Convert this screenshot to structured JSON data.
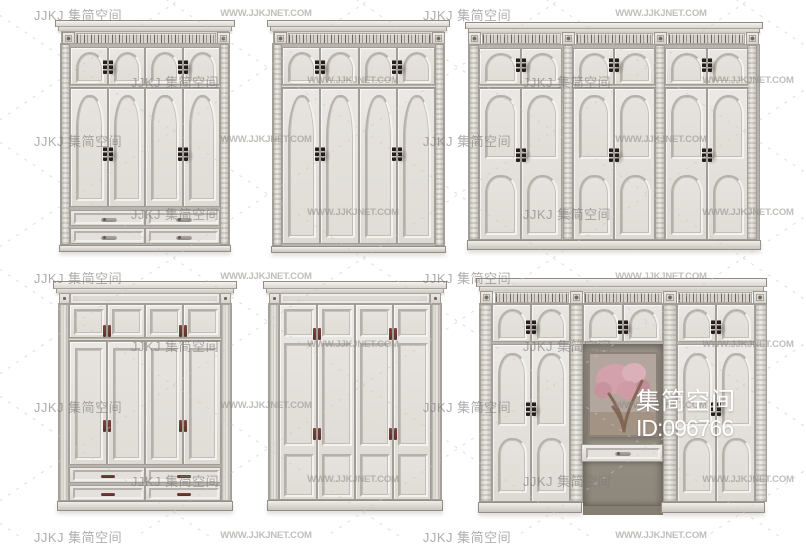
{
  "watermark": {
    "brand_label": "JJKJ 集简空间",
    "site_label": "WWW.JJKJNET.COM"
  },
  "overlay": {
    "brand_text": "集简空间",
    "id_text": "ID:096766"
  },
  "palette": {
    "background": "#ffffff",
    "cabinet_face": "#e7e4df",
    "cabinet_trim_dark": "#8f8b84",
    "carving_ink": "#55504a",
    "hinge_black": "#241f1b",
    "handle_maroon": "#6b3831",
    "drawer_handle_grey": "#8f8a82",
    "niche_wall": "#9d968b",
    "niche_base": "#857e72",
    "painting_pink": "#d3a1ab",
    "painting_trunk": "#7c5e4b",
    "painting_backdrop": "#b2a69e",
    "watermark_grey": "#969696"
  }
}
